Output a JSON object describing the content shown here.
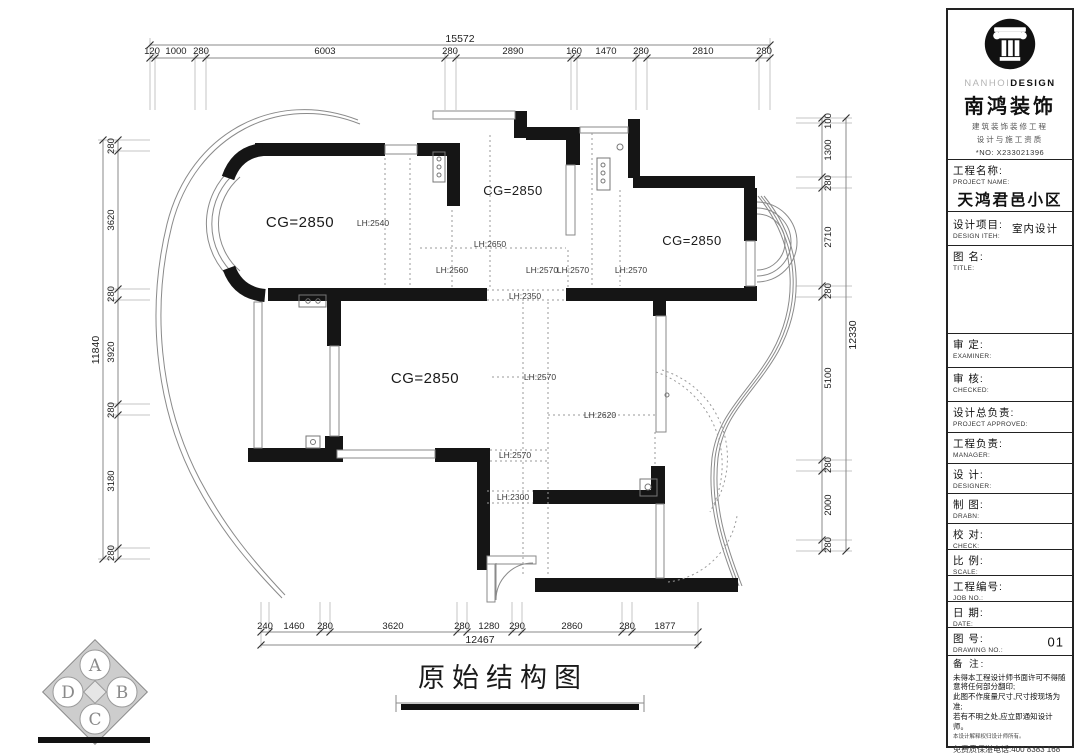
{
  "plan": {
    "title": "原始结构图",
    "room_labels": [
      "CG=2850",
      "CG=2850",
      "CG=2850",
      "CG=2850"
    ],
    "height_labels": [
      "LH:2540",
      "LH:2650",
      "LH:2560",
      "LH:2570",
      "LH:2570",
      "LH:2570",
      "LH:2350",
      "LH:2570",
      "LH:2620",
      "LH:2570",
      "LH:2300"
    ],
    "dims": {
      "top": {
        "overall": "15572",
        "segments": [
          "120",
          "1000",
          "280",
          "6003",
          "280",
          "2890",
          "160",
          "1470",
          "280",
          "2810",
          "280"
        ]
      },
      "left": {
        "overall": "11840",
        "segments": [
          "280",
          "3620",
          "280",
          "3920",
          "280",
          "3180",
          "280"
        ]
      },
      "right": {
        "overall": "12330",
        "segments": [
          "100",
          "1300",
          "280",
          "2710",
          "280",
          "5100",
          "280",
          "2000",
          "280"
        ]
      },
      "bottom": {
        "overall": "12467",
        "segments": [
          "240",
          "1460",
          "280",
          "3620",
          "280",
          "1280",
          "290",
          "2860",
          "280",
          "1877"
        ]
      }
    },
    "compass": [
      "A",
      "B",
      "C",
      "D"
    ]
  },
  "title_block": {
    "brand": {
      "en_grey": "NANHOI",
      "en_black": "DESIGN",
      "cn": "南鸿装饰",
      "slogan1": "建筑装饰装修工程",
      "slogan2": "设计与施工资质",
      "license": "*NO: X233021396"
    },
    "project": {
      "cn": "工程名称:",
      "en": "PROJECT NAME:",
      "value": "天鸿君邑小区"
    },
    "item": {
      "cn": "设计项目:",
      "en": "DESIGN ITEH:",
      "value": "室内设计"
    },
    "drawing_name": {
      "cn": "图  名:",
      "en": "TITLE:"
    },
    "examiner": {
      "cn": "审  定:",
      "en": "EXAMINER:"
    },
    "checked": {
      "cn": "审  核:",
      "en": "CHECKED:"
    },
    "approved": {
      "cn": "设计总负责:",
      "en": "PROJECT APPROVED:"
    },
    "manager": {
      "cn": "工程负责:",
      "en": "MANAGER:"
    },
    "designer": {
      "cn": "设  计:",
      "en": "DESIGNER:"
    },
    "draftsman": {
      "cn": "制  图:",
      "en": "DRABN:"
    },
    "check": {
      "cn": "校  对:",
      "en": "CHECK:"
    },
    "scale": {
      "cn": "比  例:",
      "en": "SCALE:"
    },
    "job_no": {
      "cn": "工程编号:",
      "en": "JOB NO.:"
    },
    "date": {
      "cn": "日  期:",
      "en": "DATE:"
    },
    "drawing_no": {
      "cn": "图  号:",
      "en": "DRAWING NO.:",
      "value": "01"
    },
    "notes": {
      "cn": "备  注:",
      "line1": "未得本工程设计师书面许可不得随意将任何部分翻印;",
      "line2": "此图不作度量尺寸,尺寸按现场为准;",
      "line3": "若有不明之处,应立即通知设计师。",
      "small": "本设计解释权归设计师所有。",
      "phone": "免费质保湛电话:400 8383 168"
    }
  }
}
